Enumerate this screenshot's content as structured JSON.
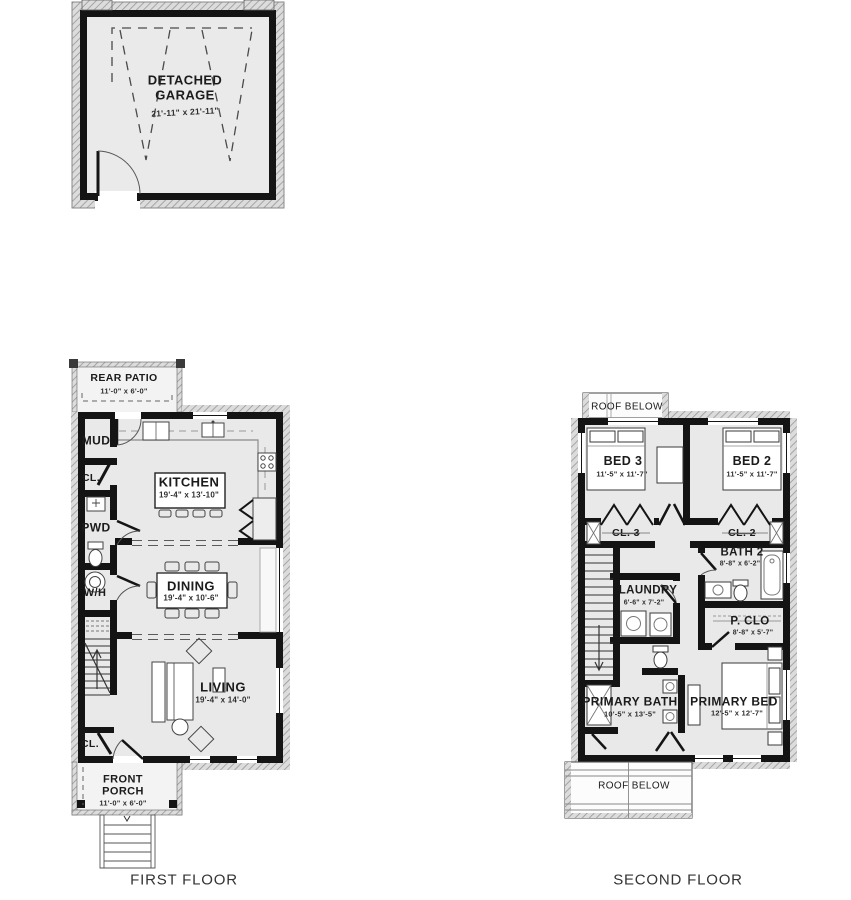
{
  "captions": {
    "first_floor": "FIRST FLOOR",
    "second_floor": "SECOND FLOOR"
  },
  "garage": {
    "name": "DETACHED GARAGE",
    "dims": "21'-11\" x 21'-11\""
  },
  "first_floor": {
    "rear_patio": {
      "name": "REAR PATIO",
      "dims": "11'-0\" x 6'-0\""
    },
    "mud": {
      "name": "MUD"
    },
    "closet_upper": {
      "name": "CL."
    },
    "powder": {
      "name": "PWD"
    },
    "water_heater": {
      "name": "W/H"
    },
    "kitchen": {
      "name": "KITCHEN",
      "dims": "19'-4\" x 13'-10\""
    },
    "dining": {
      "name": "DINING",
      "dims": "19'-4\" x 10'-6\""
    },
    "living": {
      "name": "LIVING",
      "dims": "19'-4\" x 14'-0\""
    },
    "closet_lower": {
      "name": "CL."
    },
    "front_porch": {
      "name": "FRONT PORCH",
      "dims": "11'-0\" x 6'-0\""
    }
  },
  "second_floor": {
    "roof_below_top": {
      "name": "ROOF BELOW"
    },
    "bed_3": {
      "name": "BED 3",
      "dims": "11'-5\" x 11'-7\""
    },
    "bed_2": {
      "name": "BED 2",
      "dims": "11'-5\" x 11'-7\""
    },
    "closet_3": {
      "name": "CL. 3"
    },
    "closet_2": {
      "name": "CL. 2"
    },
    "bath_2": {
      "name": "BATH 2",
      "dims": "8'-8\" x 6'-2\""
    },
    "laundry": {
      "name": "LAUNDRY",
      "dims": "6'-6\" x 7'-2\""
    },
    "primary_closet": {
      "name": "P. CLO",
      "dims": "8'-8\" x 5'-7\""
    },
    "primary_bath": {
      "name": "PRIMARY BATH",
      "dims": "10'-5\" x 13'-5\""
    },
    "primary_bed": {
      "name": "PRIMARY BED",
      "dims": "12'-5\" x 12'-7\""
    },
    "roof_below_bottom": {
      "name": "ROOF BELOW"
    }
  },
  "colors": {
    "wall": "#141414",
    "floor": "#e9e9e9",
    "porch": "#f3f3f3"
  }
}
